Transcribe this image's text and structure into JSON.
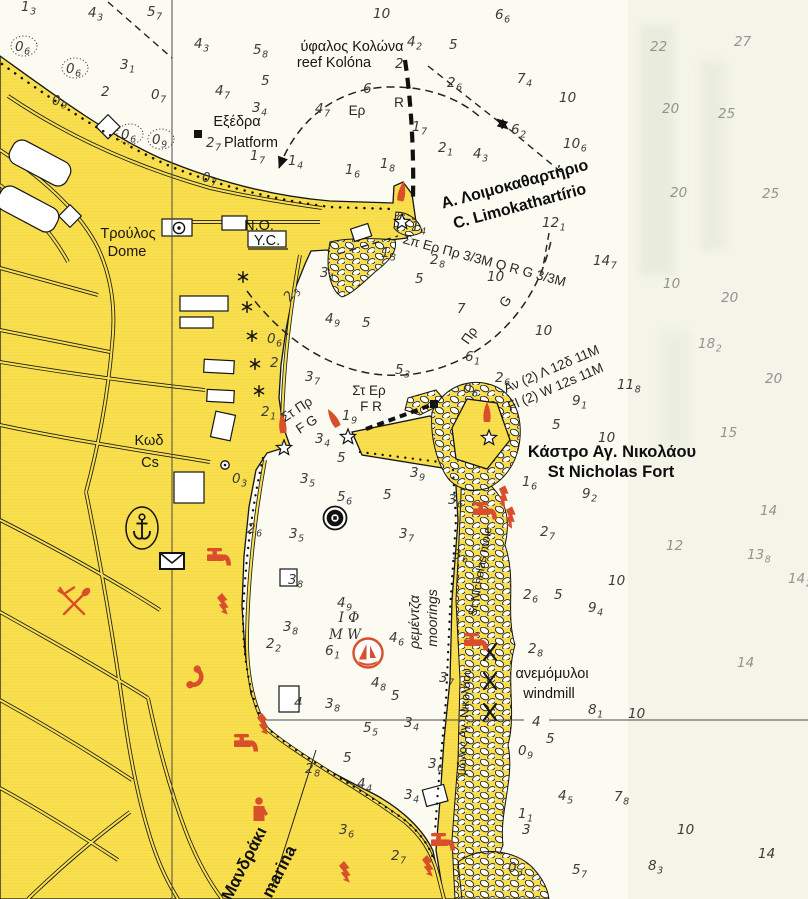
{
  "map": {
    "type": "nautical-chart-scan",
    "colors": {
      "land": "#F9E14E",
      "sea": "#FBFBF2",
      "red_icons": "#D94F2B",
      "sounding_dark": "#3b3b3b",
      "sounding_faded": "#939390"
    },
    "labels": [
      {
        "id": "reef-name-gr",
        "t": "ύφαλος Κολώνα",
        "x": 352,
        "y": 51,
        "cls": "g"
      },
      {
        "id": "reef-name-en",
        "t": "reef Kolóna",
        "x": 334,
        "y": 67,
        "cls": "g"
      },
      {
        "id": "platform-gr",
        "t": "Εξέδρα",
        "x": 237,
        "y": 126,
        "cls": "g"
      },
      {
        "id": "platform-en",
        "t": "Platform",
        "x": 251,
        "y": 147,
        "cls": "g"
      },
      {
        "id": "dome-gr",
        "t": "Τρούλος",
        "x": 128,
        "y": 238,
        "cls": "g"
      },
      {
        "id": "dome-en",
        "t": "Dome",
        "x": 127,
        "y": 256,
        "cls": "g"
      },
      {
        "id": "no",
        "t": "Ν.Ο.",
        "x": 259,
        "y": 230,
        "cls": "g"
      },
      {
        "id": "yc",
        "t": "Υ.C.",
        "x": 267,
        "y": 245,
        "cls": "g"
      },
      {
        "id": "limok-gr",
        "t": "Α. Λοιμοκαθαρτήριο",
        "x": 516,
        "y": 189,
        "rot": -15,
        "cls": "gb"
      },
      {
        "id": "limok-en",
        "t": "C. Limokathartírio",
        "x": 521,
        "y": 211,
        "rot": -15,
        "cls": "gb"
      },
      {
        "id": "light-char-main",
        "t": "Σπ Ερ Πρ 3/3Μ   Q R G 3/3M",
        "x": 402,
        "y": 243,
        "rot": 15,
        "cls": "lc",
        "anchor": "start"
      },
      {
        "id": "sector-er",
        "t": "Ερ",
        "x": 357,
        "y": 115,
        "cls": "lc"
      },
      {
        "id": "sector-r",
        "t": "R",
        "x": 399,
        "y": 107,
        "cls": "lc"
      },
      {
        "id": "sector-pr",
        "t": "Πρ",
        "x": 473,
        "y": 338,
        "rot": -55,
        "cls": "lc"
      },
      {
        "id": "sector-g",
        "t": "G",
        "x": 509,
        "y": 304,
        "rot": -55,
        "cls": "lc"
      },
      {
        "id": "fort-gr",
        "t": "Κάστρο Αγ. Νικολάου",
        "x": 612,
        "y": 457,
        "cls": "gb2"
      },
      {
        "id": "fort-en",
        "t": "St Nicholas Fort",
        "x": 611,
        "y": 477,
        "cls": "gb2"
      },
      {
        "id": "fort-light-gr",
        "t": "Αν (2) Λ 12δ 11M",
        "x": 506,
        "y": 393,
        "rot": -23,
        "cls": "lc",
        "anchor": "start"
      },
      {
        "id": "fort-light-en",
        "t": "Fl (2) W 12s 11M",
        "x": 510,
        "y": 411,
        "rot": -23,
        "cls": "lc",
        "anchor": "start"
      },
      {
        "id": "w-entrance-gr",
        "t": "Στ Πρ",
        "x": 299,
        "y": 413,
        "rot": -33,
        "cls": "lc"
      },
      {
        "id": "w-entrance-en",
        "t": "F G",
        "x": 309,
        "y": 428,
        "rot": -33,
        "cls": "lc"
      },
      {
        "id": "e-entrance-gr",
        "t": "Στ Ερ",
        "x": 369,
        "y": 395,
        "cls": "lc"
      },
      {
        "id": "e-entrance-en",
        "t": "F R",
        "x": 371,
        "y": 411,
        "cls": "lc"
      },
      {
        "id": "seabed-gr",
        "t": "Κωδ",
        "x": 149,
        "y": 445,
        "cls": "g"
      },
      {
        "id": "seabed-en",
        "t": "Cs",
        "x": 150,
        "y": 467,
        "cls": "g"
      },
      {
        "id": "moorings-gr",
        "t": "ρεμέντζα",
        "x": 419,
        "y": 622,
        "rot": -90,
        "cls": "gi"
      },
      {
        "id": "moorings-en",
        "t": "moorings",
        "x": 437,
        "y": 618,
        "rot": -90,
        "cls": "gi"
      },
      {
        "id": "mole-gr",
        "t": "μώλος Αγ. Νικολάου",
        "x": 468,
        "y": 722,
        "rot": -87,
        "cls": "gs"
      },
      {
        "id": "mole-en",
        "t": "St Nicholas mole",
        "x": 484,
        "y": 572,
        "rot": -80,
        "cls": "gs"
      },
      {
        "id": "windmill-gr",
        "t": "ανεμόμυλοι",
        "x": 552,
        "y": 678,
        "cls": "g"
      },
      {
        "id": "windmill-en",
        "t": "windmill",
        "x": 549,
        "y": 698,
        "cls": "g"
      },
      {
        "id": "marina-gr",
        "t": "Μανδράκι",
        "x": 249,
        "y": 866,
        "rot": -63,
        "cls": "gb3"
      },
      {
        "id": "marina-en",
        "t": "marina",
        "x": 284,
        "y": 874,
        "rot": -63,
        "cls": "gb3"
      },
      {
        "id": "bottom-quality-1",
        "t": "Ι Φ",
        "x": 349,
        "y": 622,
        "cls": "sf"
      },
      {
        "id": "bottom-quality-2",
        "t": "M W",
        "x": 345,
        "y": 639,
        "cls": "sf"
      }
    ],
    "soundings": [
      [
        26,
        11,
        "1",
        "3"
      ],
      [
        93,
        17,
        "4",
        "3"
      ],
      [
        152,
        16,
        "5",
        "7"
      ],
      [
        20,
        51,
        "0",
        "6",
        {
          "c": 1
        }
      ],
      [
        71,
        73,
        "0",
        "6",
        {
          "c": 1
        }
      ],
      [
        125,
        69,
        "3",
        "1"
      ],
      [
        106,
        96,
        "2",
        ""
      ],
      [
        156,
        99,
        "0",
        "7"
      ],
      [
        57,
        105,
        "0",
        "9"
      ],
      [
        126,
        139,
        "0",
        "6",
        {
          "c": 1
        }
      ],
      [
        157,
        144,
        "0",
        "9",
        {
          "c": 1
        }
      ],
      [
        199,
        48,
        "4",
        "3"
      ],
      [
        220,
        95,
        "4",
        "7"
      ],
      [
        211,
        147,
        "2",
        "7"
      ],
      [
        255,
        160,
        "1",
        "7"
      ],
      [
        293,
        165,
        "1",
        "4"
      ],
      [
        258,
        54,
        "5",
        "8"
      ],
      [
        266,
        85,
        "5",
        ""
      ],
      [
        350,
        174,
        "1",
        "6"
      ],
      [
        385,
        168,
        "1",
        "8"
      ],
      [
        378,
        18,
        "10",
        ""
      ],
      [
        500,
        19,
        "6",
        "6"
      ],
      [
        412,
        46,
        "4",
        "2"
      ],
      [
        454,
        49,
        "5",
        ""
      ],
      [
        400,
        68,
        "2",
        ""
      ],
      [
        368,
        93,
        "6",
        ""
      ],
      [
        320,
        113,
        "4",
        "7"
      ],
      [
        257,
        112,
        "3",
        "4"
      ],
      [
        417,
        131,
        "1",
        "7"
      ],
      [
        443,
        152,
        "2",
        "1"
      ],
      [
        478,
        158,
        "4",
        "3"
      ],
      [
        452,
        87,
        "2",
        "6"
      ],
      [
        522,
        83,
        "7",
        "4"
      ],
      [
        564,
        102,
        "10",
        ""
      ],
      [
        516,
        134,
        "6",
        "2"
      ],
      [
        568,
        148,
        "10",
        "6"
      ],
      [
        655,
        51,
        "22",
        "",
        {
          "l": 1
        }
      ],
      [
        739,
        46,
        "27",
        "",
        {
          "l": 1
        }
      ],
      [
        667,
        113,
        "20",
        "",
        {
          "l": 1
        }
      ],
      [
        723,
        118,
        "25",
        "",
        {
          "l": 1
        }
      ],
      [
        675,
        197,
        "20",
        "",
        {
          "l": 1
        }
      ],
      [
        767,
        198,
        "25",
        "",
        {
          "l": 1
        }
      ],
      [
        598,
        265,
        "14",
        "7"
      ],
      [
        547,
        227,
        "12",
        "1"
      ],
      [
        668,
        288,
        "10",
        "",
        {
          "l": 1
        }
      ],
      [
        726,
        302,
        "20",
        "",
        {
          "l": 1
        }
      ],
      [
        703,
        348,
        "18",
        "2",
        {
          "l": 1
        }
      ],
      [
        770,
        383,
        "20",
        "",
        {
          "l": 1
        }
      ],
      [
        622,
        389,
        "11",
        "8"
      ],
      [
        416,
        231,
        "1",
        "4"
      ],
      [
        386,
        257,
        "1",
        "3"
      ],
      [
        435,
        264,
        "2",
        "8"
      ],
      [
        420,
        283,
        "5",
        ""
      ],
      [
        492,
        281,
        "10",
        ""
      ],
      [
        462,
        313,
        "7",
        ""
      ],
      [
        540,
        335,
        "10",
        ""
      ],
      [
        470,
        361,
        "6",
        "1"
      ],
      [
        500,
        382,
        "2",
        "6"
      ],
      [
        468,
        393,
        "0",
        "6"
      ],
      [
        400,
        374,
        "5",
        "3"
      ],
      [
        310,
        381,
        "3",
        "7"
      ],
      [
        330,
        323,
        "4",
        "9"
      ],
      [
        367,
        327,
        "5",
        ""
      ],
      [
        325,
        277,
        "3",
        "1"
      ],
      [
        293,
        298,
        "2",
        "3",
        {
          "r": -55
        }
      ],
      [
        272,
        343,
        "0",
        "6"
      ],
      [
        275,
        367,
        "2",
        ""
      ],
      [
        266,
        416,
        "2",
        "1"
      ],
      [
        237,
        483,
        "0",
        "3"
      ],
      [
        305,
        483,
        "3",
        "5"
      ],
      [
        320,
        443,
        "3",
        "4"
      ],
      [
        347,
        420,
        "1",
        "9"
      ],
      [
        342,
        462,
        "5",
        ""
      ],
      [
        415,
        477,
        "3",
        "9"
      ],
      [
        342,
        501,
        "5",
        "6"
      ],
      [
        388,
        499,
        "5",
        ""
      ],
      [
        294,
        538,
        "3",
        "5"
      ],
      [
        404,
        538,
        "3",
        "7"
      ],
      [
        453,
        504,
        "3",
        "6"
      ],
      [
        458,
        559,
        "3",
        "6"
      ],
      [
        293,
        584,
        "3",
        "8"
      ],
      [
        342,
        607,
        "4",
        "9"
      ],
      [
        288,
        631,
        "3",
        "8"
      ],
      [
        330,
        655,
        "6",
        "1"
      ],
      [
        394,
        642,
        "4",
        "6"
      ],
      [
        376,
        687,
        "4",
        "8"
      ],
      [
        396,
        700,
        "5",
        ""
      ],
      [
        330,
        708,
        "3",
        "8"
      ],
      [
        299,
        707,
        "4",
        ""
      ],
      [
        444,
        682,
        "3",
        "7"
      ],
      [
        577,
        405,
        "9",
        "1"
      ],
      [
        557,
        429,
        "5",
        ""
      ],
      [
        603,
        442,
        "10",
        ""
      ],
      [
        725,
        437,
        "15",
        "",
        {
          "l": 1
        }
      ],
      [
        527,
        486,
        "1",
        "6"
      ],
      [
        587,
        498,
        "9",
        "2"
      ],
      [
        545,
        536,
        "2",
        "7"
      ],
      [
        765,
        515,
        "14",
        "",
        {
          "l": 1
        }
      ],
      [
        671,
        550,
        "12",
        "",
        {
          "l": 1
        }
      ],
      [
        752,
        559,
        "13",
        "8",
        {
          "l": 1
        }
      ],
      [
        613,
        585,
        "10",
        ""
      ],
      [
        793,
        583,
        "14",
        "2",
        {
          "l": 1
        }
      ],
      [
        528,
        599,
        "2",
        "6"
      ],
      [
        559,
        599,
        "5",
        ""
      ],
      [
        593,
        612,
        "9",
        "4"
      ],
      [
        533,
        653,
        "2",
        "8"
      ],
      [
        742,
        667,
        "14",
        "",
        {
          "l": 1
        }
      ],
      [
        593,
        714,
        "8",
        "1"
      ],
      [
        633,
        718,
        "10",
        ""
      ],
      [
        537,
        726,
        "4",
        ""
      ],
      [
        551,
        743,
        "5",
        ""
      ],
      [
        523,
        755,
        "0",
        "9"
      ],
      [
        433,
        768,
        "3",
        "6"
      ],
      [
        563,
        800,
        "4",
        "5"
      ],
      [
        619,
        801,
        "7",
        "8"
      ],
      [
        682,
        834,
        "10",
        ""
      ],
      [
        763,
        858,
        "14",
        ""
      ],
      [
        653,
        870,
        "8",
        "3"
      ],
      [
        577,
        874,
        "5",
        "7"
      ],
      [
        513,
        872,
        "0",
        "3"
      ],
      [
        523,
        818,
        "1",
        "1"
      ],
      [
        527,
        834,
        "3",
        ""
      ],
      [
        362,
        788,
        "4",
        "4"
      ],
      [
        409,
        799,
        "3",
        "4"
      ],
      [
        344,
        834,
        "3",
        "6"
      ],
      [
        396,
        860,
        "2",
        "7"
      ],
      [
        368,
        732,
        "5",
        "5"
      ],
      [
        409,
        727,
        "3",
        "4"
      ],
      [
        348,
        762,
        "5",
        ""
      ],
      [
        310,
        773,
        "2",
        "8"
      ],
      [
        252,
        533,
        "2",
        "6"
      ],
      [
        271,
        648,
        "2",
        "2"
      ],
      [
        207,
        182,
        "0",
        "7"
      ]
    ],
    "symbols": {
      "light_flare": [
        [
          401,
          197,
          10
        ],
        [
          283,
          429,
          -5
        ],
        [
          336,
          423,
          -30
        ],
        [
          487,
          418,
          0
        ]
      ],
      "light_star": [
        [
          402,
          222,
          0
        ],
        [
          284,
          448,
          0
        ],
        [
          348,
          437,
          0
        ],
        [
          489,
          438,
          0
        ]
      ],
      "rock_asterisk": [
        [
          243,
          277,
          0
        ],
        [
          247,
          307,
          0
        ],
        [
          252,
          336,
          0
        ],
        [
          255,
          364,
          0
        ],
        [
          259,
          391,
          0
        ]
      ],
      "windmill_x": [
        [
          490,
          652,
          0
        ],
        [
          490,
          681,
          0
        ],
        [
          490,
          712,
          0
        ]
      ],
      "water_tap": [
        [
          216,
          558,
          0
        ],
        [
          243,
          744,
          0
        ],
        [
          440,
          843,
          0
        ],
        [
          482,
          512,
          0
        ],
        [
          473,
          643,
          0
        ]
      ],
      "electricity": [
        [
          222,
          605,
          0
        ],
        [
          262,
          725,
          0
        ],
        [
          344,
          873,
          0
        ],
        [
          427,
          867,
          0
        ],
        [
          502,
          497,
          15
        ],
        [
          509,
          518,
          15
        ]
      ],
      "telephone": [
        [
          196,
          678,
          115
        ]
      ],
      "restaurant": [
        [
          74,
          604,
          0
        ]
      ],
      "wc_person": [
        [
          259,
          811,
          0
        ]
      ],
      "post_envelope": [
        [
          172,
          561,
          0
        ]
      ],
      "anchorage": [
        [
          142,
          528,
          0
        ]
      ],
      "mooring_buoy": [
        [
          335,
          518,
          0
        ]
      ],
      "marina_badge": [
        [
          368,
          653,
          0
        ]
      ],
      "black_square": [
        [
          198,
          134,
          0
        ],
        [
          434,
          404,
          0
        ]
      ],
      "circle_dot": [
        [
          225,
          465,
          0
        ]
      ],
      "dome_symbol": [
        [
          179,
          228,
          0
        ]
      ]
    }
  }
}
